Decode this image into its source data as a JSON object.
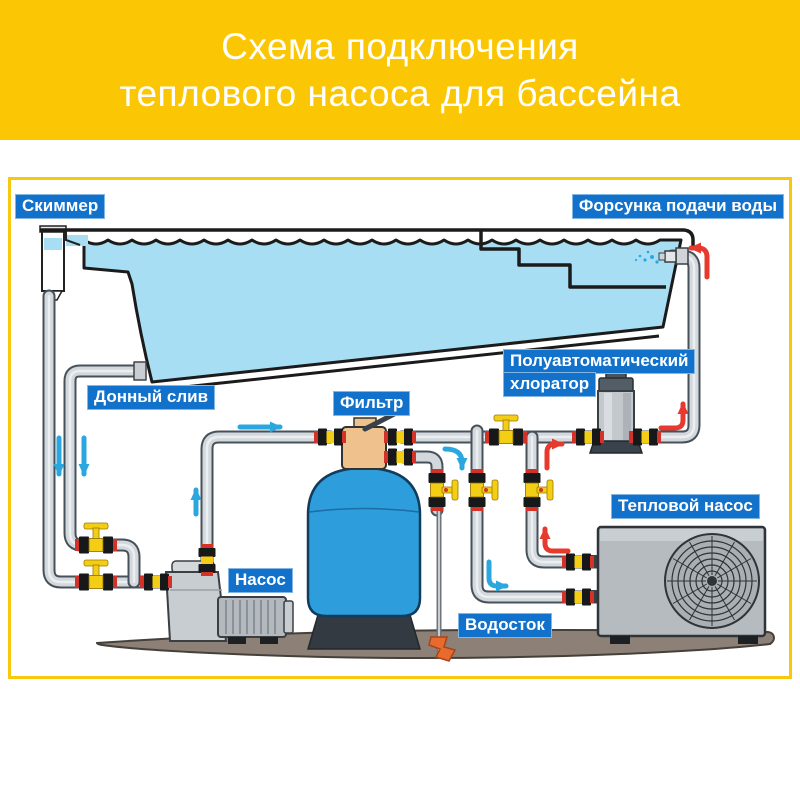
{
  "header": {
    "line1": "Схема подключения",
    "line2": "теплового насоса для бассейна"
  },
  "labels": {
    "skimmer": "Скиммер",
    "inlet_nozzle": "Форсунка подачи воды",
    "bottom_drain": "Донный слив",
    "filter": "Фильтр",
    "chlorinator_line1": "Полуавтоматический",
    "chlorinator_line2": "хлоратор",
    "pump": "Насос",
    "heat_pump": "Тепловой насос",
    "drain": "Водосток"
  },
  "colors": {
    "header-bg": "#FBC705",
    "frame-border": "#F6C80F",
    "label-bg": "#1272CB",
    "label-text": "#FFFFFF",
    "water-blue": "#A8DEF3",
    "pipe-gray": "#D3D8DC",
    "pipe-outline": "#47515A",
    "valve-yellow": "#F3CE14",
    "valve-red": "#D23227",
    "filter-blue": "#2D9EDB",
    "multiport-tan": "#EFC28D",
    "equipment-gray": "#B6BBC0",
    "ground-brown": "#8D8177",
    "arrow-blue": "#2BA7E0",
    "arrow-red": "#E8392E",
    "drain-orange": "#E96A2E"
  }
}
